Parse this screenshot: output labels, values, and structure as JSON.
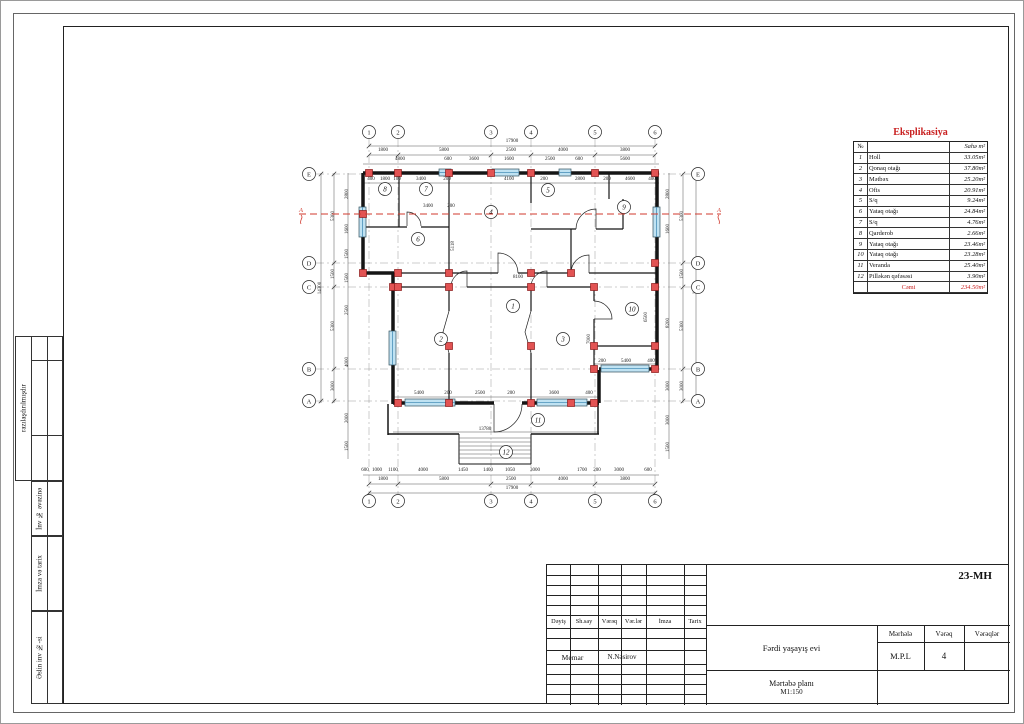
{
  "sheet": {
    "code": "23-MH"
  },
  "sidebar": {
    "items": [
      {
        "label": "razılaşdırılmışdır"
      },
      {
        "label": "İnv № əvəzinə"
      },
      {
        "label": "İmza və tarix"
      },
      {
        "label": "Əslin inv №-si"
      }
    ]
  },
  "eksplikasiya": {
    "title": "Eksplikasiya",
    "col_no": "№",
    "col_area": "Sahə m²",
    "rows": [
      [
        "1",
        "Holl",
        "33.05m²"
      ],
      [
        "2",
        "Qonaq otağı",
        "37.80m²"
      ],
      [
        "3",
        "Mətbəx",
        "25.20m²"
      ],
      [
        "4",
        "Ofis",
        "20.91m²"
      ],
      [
        "5",
        "S/q",
        "9.24m²"
      ],
      [
        "6",
        "Yataq otağı",
        "24.84m²"
      ],
      [
        "7",
        "S/q",
        "4.76m²"
      ],
      [
        "8",
        "Qarderob",
        "2.66m²"
      ],
      [
        "9",
        "Yataq otağı",
        "23.46m²"
      ],
      [
        "10",
        "Yataq otağı",
        "23.28m²"
      ],
      [
        "11",
        "Veranda",
        "25.40m²"
      ],
      [
        "12",
        "Pilləkən qəfəsəsi",
        "3.90m²"
      ]
    ],
    "total_label": "Cəmi",
    "total_value": "234.50m²"
  },
  "titleblock": {
    "code": "23-MH",
    "cols": [
      "Dəyiş",
      "Sh.say",
      "Vərəq",
      "Vər.lər",
      "İmza",
      "Tarix"
    ],
    "memar_label": "Memar",
    "memar_name": "N.Nəsirov",
    "project": "Fərdi yaşayış evi",
    "drawing": "Mərtəbə planı",
    "scale": "M1:150",
    "stage_label": "Mərhələ",
    "sheet_label": "Vərəq",
    "sheets_label": "Vərəqlər",
    "stage": "M.P.L",
    "sheet_no": "4"
  },
  "plan": {
    "colors": {
      "wall": "#151515",
      "dim": "#222222",
      "grid": "#999999",
      "red": "#d03a2e",
      "column_fill": "#e25353",
      "column_stroke": "#8b1b1b",
      "window_fill": "#bfe2f2"
    },
    "grid_cols": [
      {
        "l": "1",
        "x": 368
      },
      {
        "l": "2",
        "x": 397
      },
      {
        "l": "3",
        "x": 490
      },
      {
        "l": "4",
        "x": 530
      },
      {
        "l": "5",
        "x": 594
      },
      {
        "l": "6",
        "x": 654
      }
    ],
    "grid_rows": [
      {
        "l": "E",
        "y": 173
      },
      {
        "l": "D",
        "y": 262
      },
      {
        "l": "C",
        "y": 286
      },
      {
        "l": "B",
        "y": 368
      },
      {
        "l": "A",
        "y": 400
      }
    ],
    "walls": [
      [
        362,
        172,
        658,
        172,
        3.5
      ],
      [
        362,
        172,
        362,
        273,
        3.5
      ],
      [
        656,
        172,
        656,
        369,
        3.5
      ],
      [
        362,
        272,
        393,
        272,
        3.5
      ],
      [
        392,
        272,
        392,
        403,
        3.5
      ],
      [
        598,
        368,
        656,
        368,
        3.5
      ],
      [
        598,
        369,
        598,
        402,
        3.5
      ],
      [
        392,
        402,
        493,
        402,
        3.5
      ],
      [
        521,
        402,
        598,
        402,
        3.5
      ],
      [
        387,
        403,
        387,
        434,
        1.5
      ],
      [
        387,
        433,
        458,
        433,
        1.5
      ],
      [
        530,
        433,
        598,
        433,
        1.5
      ],
      [
        597,
        403,
        597,
        433,
        1.5
      ],
      [
        458,
        433,
        458,
        463,
        1
      ],
      [
        530,
        433,
        530,
        463,
        1
      ],
      [
        458,
        463,
        530,
        463,
        1
      ],
      [
        398,
        172,
        398,
        226,
        1.2
      ],
      [
        362,
        226,
        406,
        226,
        1.2
      ],
      [
        420,
        226,
        448,
        226,
        1.2
      ],
      [
        448,
        172,
        448,
        272,
        1.2
      ],
      [
        530,
        172,
        530,
        202,
        1.2
      ],
      [
        608,
        172,
        608,
        198,
        1.2
      ],
      [
        570,
        228,
        570,
        272,
        1.2
      ],
      [
        530,
        228,
        575,
        228,
        1.2
      ],
      [
        595,
        228,
        622,
        228,
        1.2
      ],
      [
        622,
        198,
        622,
        228,
        1.2
      ],
      [
        392,
        272,
        497,
        272,
        1.2
      ],
      [
        517,
        272,
        570,
        272,
        1.2
      ],
      [
        588,
        272,
        656,
        272,
        1.2
      ],
      [
        392,
        286,
        450,
        286,
        1.2
      ],
      [
        466,
        286,
        530,
        286,
        1.2
      ],
      [
        546,
        286,
        593,
        286,
        1.2
      ],
      [
        448,
        286,
        448,
        310,
        1.2
      ],
      [
        448,
        352,
        448,
        402,
        1.2
      ],
      [
        530,
        286,
        530,
        310,
        1.2
      ],
      [
        530,
        352,
        530,
        402,
        1.2
      ],
      [
        593,
        286,
        593,
        300,
        1.2
      ],
      [
        593,
        318,
        593,
        368,
        1.2
      ],
      [
        593,
        345,
        656,
        345,
        1.2
      ]
    ],
    "columns": [
      [
        368,
        172
      ],
      [
        397,
        172
      ],
      [
        448,
        172
      ],
      [
        490,
        172
      ],
      [
        530,
        172
      ],
      [
        594,
        172
      ],
      [
        654,
        172
      ],
      [
        362,
        213
      ],
      [
        362,
        272
      ],
      [
        397,
        272
      ],
      [
        448,
        272
      ],
      [
        530,
        272
      ],
      [
        570,
        272
      ],
      [
        654,
        262
      ],
      [
        654,
        286
      ],
      [
        392,
        286
      ],
      [
        397,
        286
      ],
      [
        448,
        286
      ],
      [
        530,
        286
      ],
      [
        593,
        286
      ],
      [
        448,
        345
      ],
      [
        530,
        345
      ],
      [
        593,
        345
      ],
      [
        654,
        345
      ],
      [
        397,
        402
      ],
      [
        448,
        402
      ],
      [
        530,
        402
      ],
      [
        570,
        402
      ],
      [
        593,
        402
      ],
      [
        593,
        368
      ],
      [
        654,
        368
      ]
    ],
    "windows": [
      [
        438,
        168,
        12,
        7
      ],
      [
        491,
        168,
        27,
        7
      ],
      [
        558,
        168,
        12,
        7
      ],
      [
        358,
        206,
        7,
        30
      ],
      [
        652,
        206,
        7,
        30
      ],
      [
        388,
        330,
        7,
        34
      ],
      [
        404,
        398,
        50,
        7
      ],
      [
        536,
        398,
        50,
        7
      ],
      [
        600,
        364,
        48,
        7
      ]
    ],
    "doors": [
      "M493,403 L493,431 A28,28 0 0 0 521,403",
      "M406,225 L406,211 A14,14 0 0 1 420,225",
      "M497,272 L497,252 A20,20 0 0 1 517,272",
      "M588,272 L588,254 A18,18 0 0 0 570,272",
      "M595,228 L595,208 A20,20 0 0 0 575,228",
      "M593,318 L611,318 A18,18 0 0 0 593,300",
      "M466,286 L466,270 A16,16 0 0 0 450,286",
      "M546,286 L546,270 A16,16 0 0 0 530,286",
      "M448,310 L442,331 L448,352",
      "M530,310 L524,331 L530,352"
    ],
    "stairs": {
      "x1": 458,
      "x2": 530,
      "ys": [
        437,
        441,
        445,
        449,
        453,
        457
      ]
    },
    "rooms": [
      [
        "1",
        512,
        305
      ],
      [
        "2",
        440,
        338
      ],
      [
        "3",
        562,
        338
      ],
      [
        "4",
        490,
        211
      ],
      [
        "5",
        547,
        189
      ],
      [
        "6",
        417,
        238
      ],
      [
        "7",
        425,
        188
      ],
      [
        "8",
        384,
        188
      ],
      [
        "9",
        623,
        206
      ],
      [
        "10",
        631,
        308
      ],
      [
        "11",
        537,
        419
      ],
      [
        "12",
        505,
        451
      ]
    ],
    "dim_lines": [
      [
        368,
        145,
        654,
        145
      ],
      [
        368,
        154,
        654,
        154
      ],
      [
        362,
        163,
        658,
        163
      ],
      [
        362,
        182,
        658,
        182
      ],
      [
        392,
        396,
        598,
        396
      ],
      [
        593,
        363,
        656,
        363
      ],
      [
        392,
        431,
        598,
        431
      ],
      [
        362,
        474,
        658,
        474
      ],
      [
        368,
        483,
        654,
        483
      ],
      [
        368,
        492,
        654,
        492
      ],
      [
        347,
        172,
        347,
        458
      ],
      [
        333,
        172,
        333,
        402
      ],
      [
        320,
        172,
        320,
        402
      ],
      [
        668,
        172,
        668,
        458
      ],
      [
        682,
        172,
        682,
        402
      ],
      [
        695,
        172,
        695,
        402
      ]
    ],
    "dims": [
      [
        "17900",
        511,
        141,
        0
      ],
      [
        "1800",
        382,
        150,
        0
      ],
      [
        "5800",
        443,
        150,
        0
      ],
      [
        "2500",
        510,
        150,
        0
      ],
      [
        "4000",
        562,
        150,
        0
      ],
      [
        "3800",
        624,
        150,
        0
      ],
      [
        "4800",
        399,
        159,
        0
      ],
      [
        "600",
        447,
        159,
        0
      ],
      [
        "3600",
        473,
        159,
        0
      ],
      [
        "1600",
        508,
        159,
        0
      ],
      [
        "2500",
        549,
        159,
        0
      ],
      [
        "600",
        578,
        159,
        0
      ],
      [
        "5600",
        624,
        159,
        0
      ],
      [
        "400",
        370,
        179,
        0
      ],
      [
        "1800",
        384,
        179,
        0
      ],
      [
        "100",
        396,
        179,
        0
      ],
      [
        "3400",
        420,
        179,
        0
      ],
      [
        "200",
        446,
        179,
        0
      ],
      [
        "4100",
        508,
        179,
        0
      ],
      [
        "200",
        543,
        179,
        0
      ],
      [
        "2800",
        579,
        179,
        0
      ],
      [
        "200",
        606,
        179,
        0
      ],
      [
        "4600",
        629,
        179,
        0
      ],
      [
        "400",
        651,
        179,
        0
      ],
      [
        "3400",
        427,
        206,
        0
      ],
      [
        "200",
        450,
        206,
        0
      ],
      [
        "8100",
        517,
        277,
        0
      ],
      [
        "5118",
        453,
        245,
        1
      ],
      [
        "7000",
        589,
        338,
        1
      ],
      [
        "6500",
        646,
        316,
        1
      ],
      [
        "5400",
        418,
        393,
        0
      ],
      [
        "200",
        447,
        393,
        0
      ],
      [
        "2500",
        479,
        393,
        0
      ],
      [
        "200",
        510,
        393,
        0
      ],
      [
        "3600",
        553,
        393,
        0
      ],
      [
        "400",
        588,
        393,
        0
      ],
      [
        "200",
        601,
        361,
        0
      ],
      [
        "5400",
        625,
        361,
        0
      ],
      [
        "400",
        650,
        361,
        0
      ],
      [
        "13780",
        484,
        429,
        0
      ],
      [
        "600",
        364,
        470,
        0
      ],
      [
        "1000",
        376,
        470,
        0
      ],
      [
        "1100",
        392,
        470,
        0
      ],
      [
        "4000",
        422,
        470,
        0
      ],
      [
        "1450",
        462,
        470,
        0
      ],
      [
        "1400",
        487,
        470,
        0
      ],
      [
        "1050",
        509,
        470,
        0
      ],
      [
        "3000",
        534,
        470,
        0
      ],
      [
        "1700",
        581,
        470,
        0
      ],
      [
        "200",
        596,
        470,
        0
      ],
      [
        "3000",
        618,
        470,
        0
      ],
      [
        "600",
        647,
        470,
        0
      ],
      [
        "1800",
        382,
        479,
        0
      ],
      [
        "5800",
        443,
        479,
        0
      ],
      [
        "2500",
        510,
        479,
        0
      ],
      [
        "4000",
        562,
        479,
        0
      ],
      [
        "3800",
        624,
        479,
        0
      ],
      [
        "17900",
        511,
        488,
        0
      ],
      [
        "2800",
        347,
        193,
        1
      ],
      [
        "1600",
        347,
        228,
        1
      ],
      [
        "1500",
        347,
        253,
        1
      ],
      [
        "1500",
        347,
        277,
        1
      ],
      [
        "2500",
        347,
        309,
        1
      ],
      [
        "4000",
        347,
        361,
        1
      ],
      [
        "2000",
        347,
        417,
        1
      ],
      [
        "1500",
        347,
        445,
        1
      ],
      [
        "5300",
        333,
        215,
        1
      ],
      [
        "1500",
        333,
        273,
        1
      ],
      [
        "5300",
        333,
        325,
        1
      ],
      [
        "3000",
        333,
        385,
        1
      ],
      [
        "14300",
        320,
        287,
        1
      ],
      [
        "2800",
        668,
        193,
        1
      ],
      [
        "1600",
        668,
        228,
        1
      ],
      [
        "8200",
        668,
        322,
        1
      ],
      [
        "3000",
        668,
        385,
        1
      ],
      [
        "3000",
        668,
        419,
        1
      ],
      [
        "1500",
        668,
        446,
        1
      ],
      [
        "5300",
        682,
        215,
        1
      ],
      [
        "1500",
        682,
        273,
        1
      ],
      [
        "5300",
        682,
        325,
        1
      ],
      [
        "3000",
        682,
        385,
        1
      ],
      [
        "14300",
        695,
        287,
        1
      ]
    ],
    "section": {
      "y": 213,
      "x1": 298,
      "x2": 720,
      "label": "A"
    }
  }
}
